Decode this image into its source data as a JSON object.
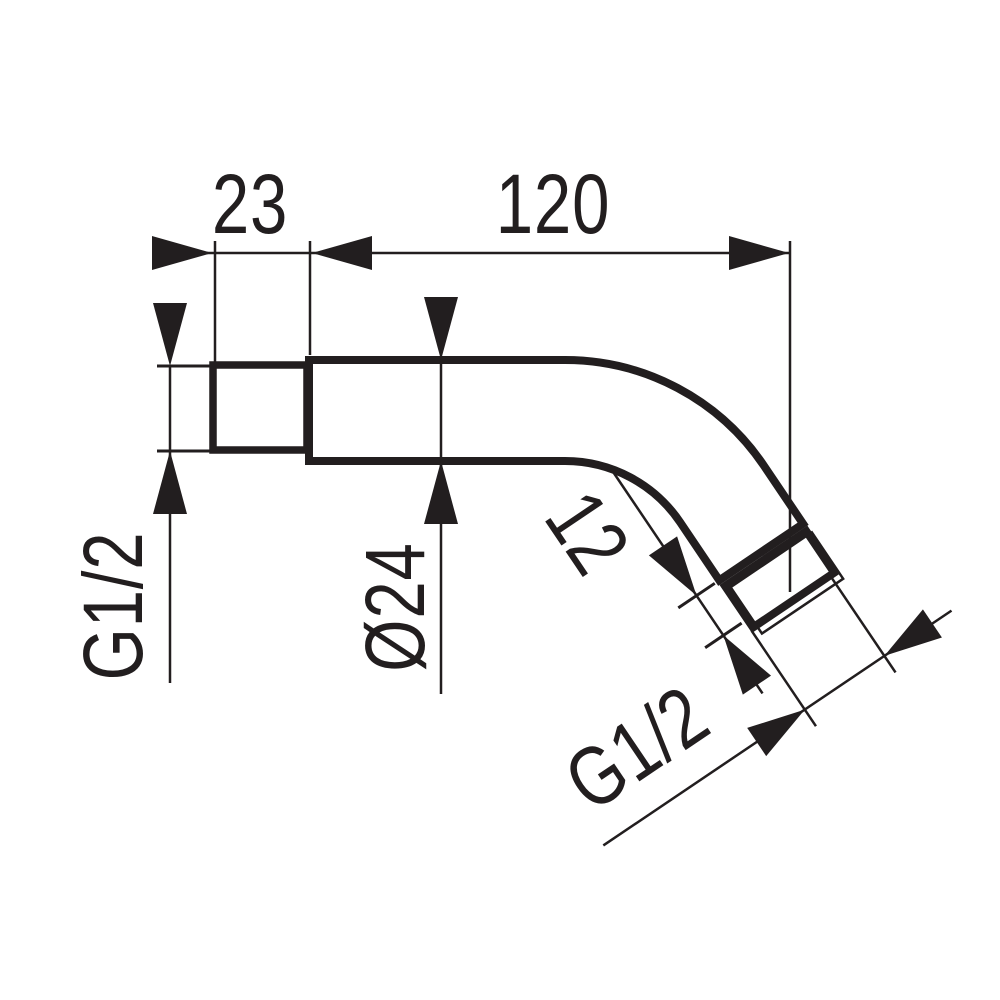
{
  "drawing": {
    "kind": "technical-dimension-drawing",
    "subject": "wall-mounted shower arm, side elevation",
    "colors": {
      "ink": "#221e1f",
      "background": "#ffffff"
    },
    "labels": {
      "wall_connector_length": "23",
      "arm_horizontal_length": "120",
      "wall_thread": "G1/2",
      "tube_diameter": "Ø24",
      "outlet_end_length": "12",
      "outlet_thread": "G1/2"
    }
  }
}
